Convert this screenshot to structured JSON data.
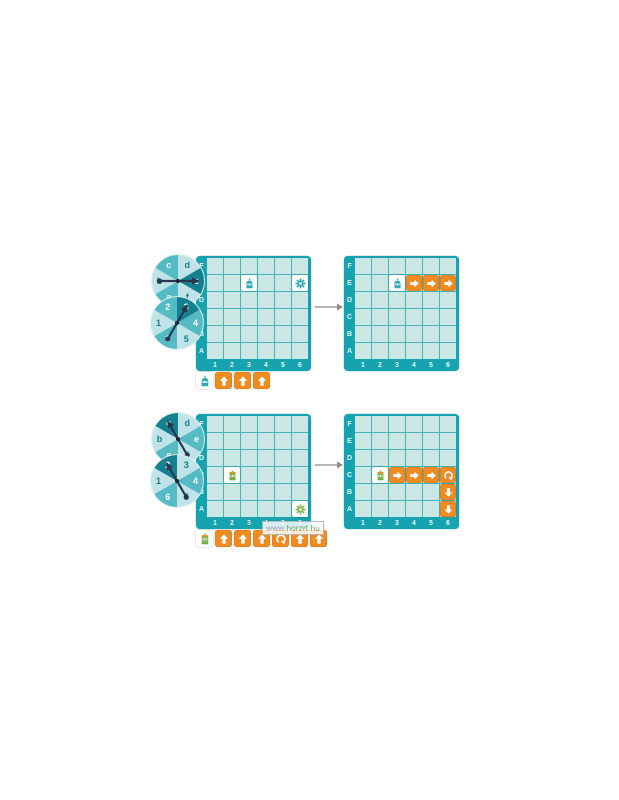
{
  "watermark": {
    "prefix": "www.",
    "domain": "horzrt.hu"
  },
  "colors": {
    "frame_teal": "#17a2af",
    "cell_mint": "#cbe7e3",
    "gridline": "#45b4bc",
    "card_orange": "#f08b21",
    "card_orange_border": "#dd7a12",
    "spinner_light": "#bfe3e6",
    "spinner_mid": "#54bac4",
    "spinner_dark": "#15808f",
    "spinner_text_on_light": "#157f8f",
    "needle_navy": "#2a3550",
    "robot_teal": "#2ba9b9",
    "robot_green": "#7cb94e",
    "robot_green_accent": "#f08b21",
    "gear_teal": "#2ba9b9",
    "gear_green": "#7cb94e",
    "transform_arrow_gray": "#8c8c8c"
  },
  "board_labels": {
    "rows": [
      "F",
      "E",
      "D",
      "C",
      "B",
      "A"
    ],
    "cols": [
      "1",
      "2",
      "3",
      "4",
      "5",
      "6"
    ]
  },
  "puzzles": [
    {
      "name": "puzzle-1",
      "letter_spinner": {
        "labels_clockwise_from_top": [
          "d",
          "e",
          "f",
          "a",
          "b",
          "c"
        ],
        "selected": "e"
      },
      "number_spinner": {
        "labels_clockwise_from_top": [
          "3",
          "4",
          "5",
          "6",
          "1",
          "2"
        ],
        "selected": "3"
      },
      "board_before": {
        "items": [
          {
            "type": "robot-teal",
            "cell": "E3"
          },
          {
            "type": "gear-teal",
            "cell": "E6"
          }
        ]
      },
      "board_after": {
        "items": [
          {
            "type": "robot-teal",
            "cell": "E3"
          },
          {
            "type": "card-right",
            "cell": "E4"
          },
          {
            "type": "card-right",
            "cell": "E5"
          },
          {
            "type": "card-right",
            "cell": "E6"
          }
        ]
      },
      "sequence": [
        "robot-teal",
        "card-up",
        "card-up",
        "card-up"
      ]
    },
    {
      "name": "puzzle-2",
      "letter_spinner": {
        "labels_clockwise_from_top": [
          "d",
          "e",
          "f",
          "a",
          "b",
          "c"
        ],
        "selected": "c"
      },
      "number_spinner": {
        "labels_clockwise_from_top": [
          "3",
          "4",
          "5",
          "6",
          "1",
          "2"
        ],
        "selected": "2"
      },
      "board_before": {
        "items": [
          {
            "type": "robot-green",
            "cell": "C2"
          },
          {
            "type": "gear-green",
            "cell": "A6"
          }
        ]
      },
      "board_after": {
        "items": [
          {
            "type": "robot-green",
            "cell": "C2"
          },
          {
            "type": "card-right",
            "cell": "C3"
          },
          {
            "type": "card-right",
            "cell": "C4"
          },
          {
            "type": "card-right",
            "cell": "C5"
          },
          {
            "type": "card-turn-right",
            "cell": "C6"
          },
          {
            "type": "card-down",
            "cell": "B6"
          },
          {
            "type": "card-down",
            "cell": "A6"
          }
        ]
      },
      "sequence": [
        "robot-green",
        "card-up",
        "card-up",
        "card-up",
        "card-turn-right",
        "card-up",
        "card-up"
      ]
    }
  ]
}
